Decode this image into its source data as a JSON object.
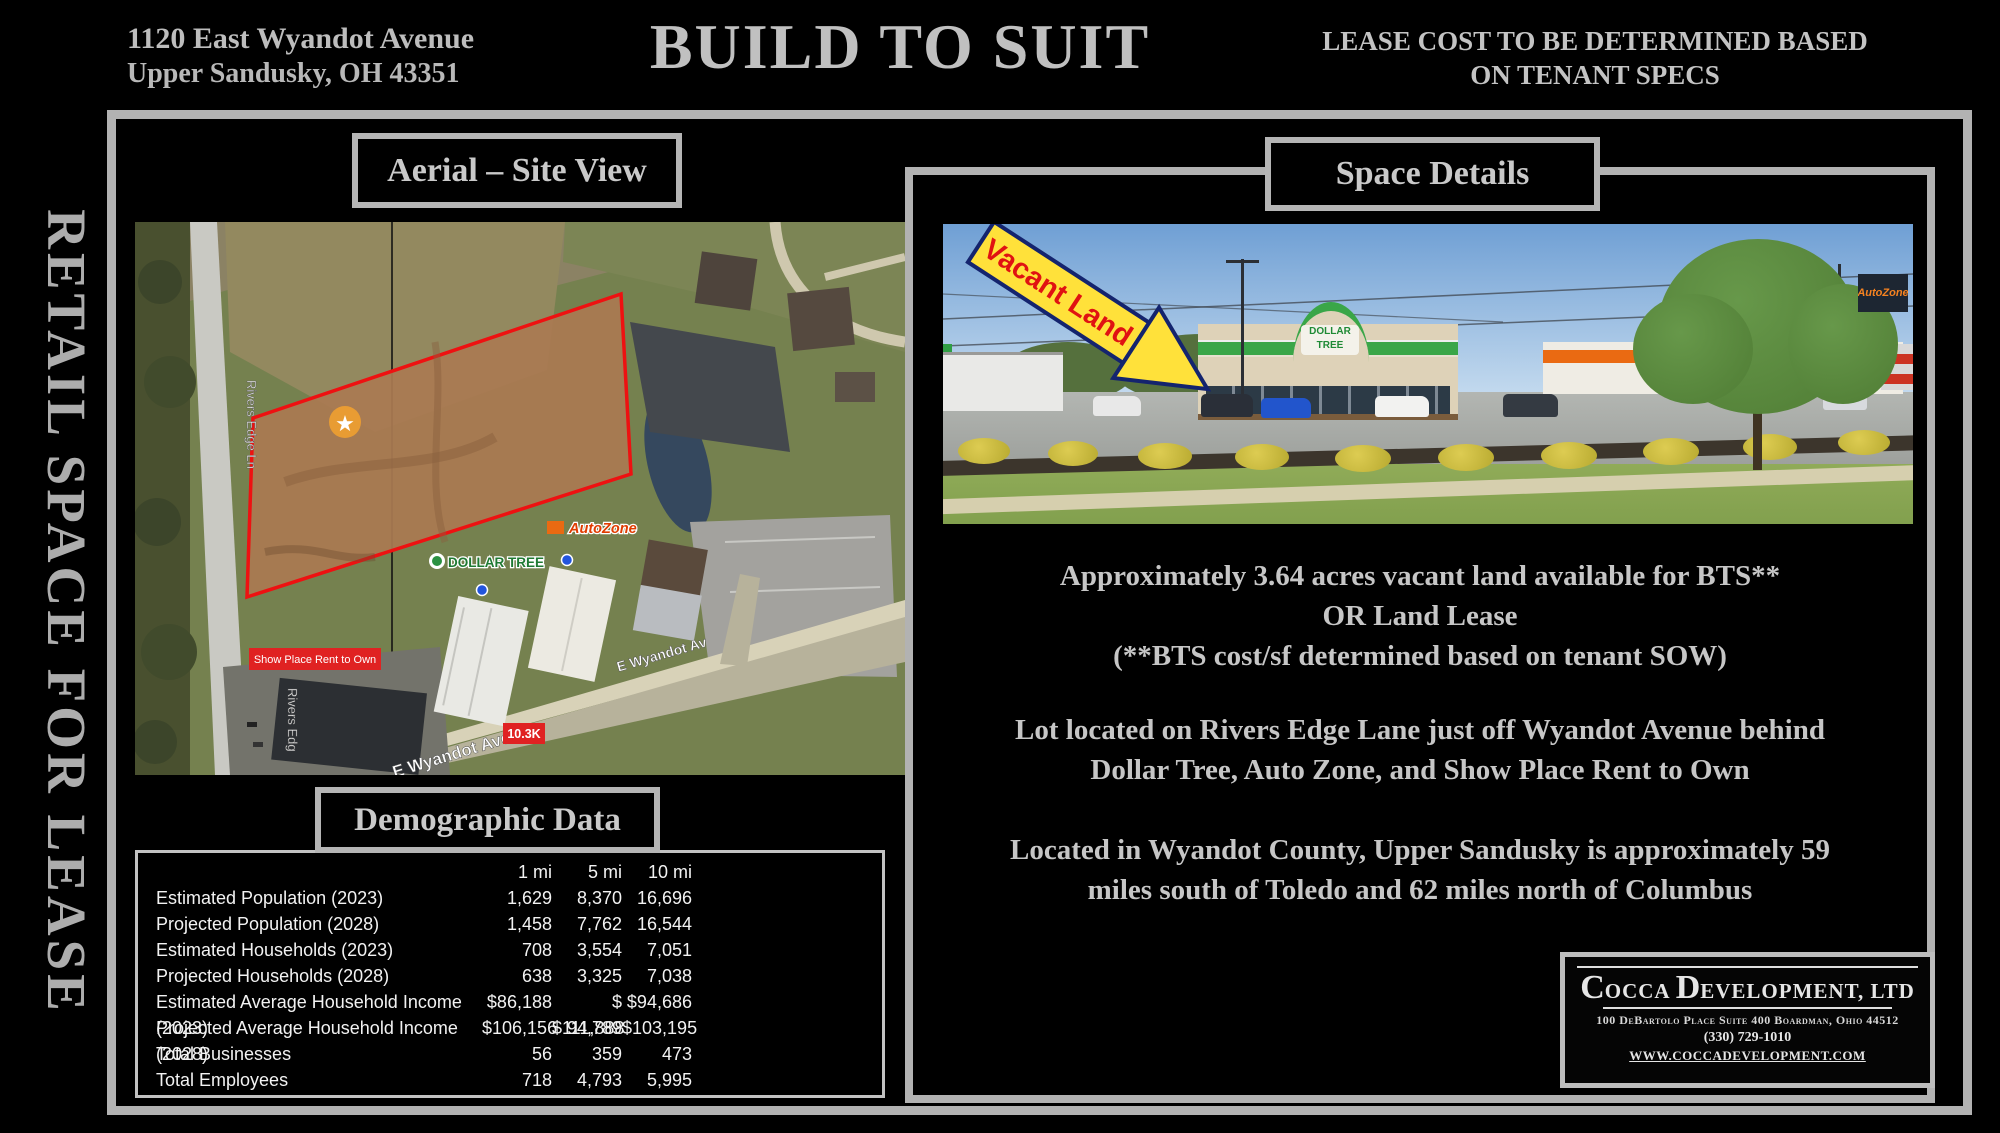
{
  "header": {
    "address_line1": "1120 East Wyandot Avenue",
    "address_line2": "Upper Sandusky, OH 43351",
    "title": "BUILD TO SUIT",
    "lease_note_line1": "LEASE COST TO BE DETERMINED BASED",
    "lease_note_line2": "ON TENANT SPECS"
  },
  "sidebar": {
    "vertical_text": "RETAIL SPACE FOR LEASE"
  },
  "aerial": {
    "title": "Aerial – Site View",
    "map_labels": {
      "road_vertical": "Rivers Edge Ln",
      "road_vertical_partial": "Rivers Edg",
      "road_diagonal": "E Wyandot Ave",
      "road_diagonal_short": "E Wyandot Av",
      "traffic_count": "10.3K",
      "store_dollar_tree": "DOLLAR TREE",
      "store_autozone": "AutoZone",
      "store_showplace": "Show Place Rent to Own",
      "marker_glyph": "★"
    }
  },
  "space_details": {
    "title": "Space Details",
    "photo_annotation": "Vacant Land",
    "photo_sign_dollar_tree": "DOLLAR TREE",
    "photo_sign_autozone": "AutoZone",
    "paragraph1": [
      "Approximately 3.64 acres vacant land available for BTS**",
      "OR Land Lease",
      "(**BTS cost/sf determined based on tenant SOW)"
    ],
    "paragraph2": [
      "Lot located on Rivers Edge Lane just off Wyandot Avenue behind",
      "Dollar Tree, Auto Zone, and Show Place Rent to Own"
    ],
    "paragraph3": [
      "Located in Wyandot County, Upper Sandusky is approximately 59",
      "miles south of Toledo and 62 miles north of Columbus"
    ]
  },
  "demographics": {
    "title": "Demographic Data",
    "columns": [
      "1 mi",
      "5 mi",
      "10 mi"
    ],
    "rows": [
      {
        "label": "Estimated Population (2023)",
        "values": [
          "1,629",
          "8,370",
          "16,696"
        ]
      },
      {
        "label": "Projected Population (2028)",
        "values": [
          "1,458",
          "7,762",
          "16,544"
        ]
      },
      {
        "label": "Estimated Households (2023)",
        "values": [
          "708",
          "3,554",
          "7,051"
        ]
      },
      {
        "label": "Projected Households (2028)",
        "values": [
          "638",
          "3,325",
          "7,038"
        ]
      },
      {
        "label": "Estimated Average Household Income (2023)",
        "values": [
          "$86,188",
          "$ 94,789",
          "$94,686"
        ]
      },
      {
        "label": "Projected Average Household Income (2028)",
        "values": [
          "$106,156",
          "$111,888",
          "$103,195"
        ]
      },
      {
        "label": "Total Businesses",
        "values": [
          "56",
          "359",
          "473"
        ]
      },
      {
        "label": "Total Employees",
        "values": [
          "718",
          "4,793",
          "5,995"
        ]
      }
    ]
  },
  "company": {
    "name_parts": [
      "C",
      "OCCA ",
      "D",
      "EVELOPMENT, LTD"
    ],
    "address": "100 DeBartolo Place Suite 400 Boardman, Ohio 44512",
    "phone": "(330) 729-1010",
    "website": "WWW.COCCADEVELOPMENT.COM"
  },
  "colors": {
    "background": "#000000",
    "frame_gray": "#b2b2b2",
    "text_gray": "#c6c6c6",
    "table_white": "#f2f2f2",
    "parcel_outline_red": "#ee1111",
    "label_red": "#e02222",
    "arrow_yellow": "#ffe13a",
    "arrow_outline_navy": "#14246e",
    "arrow_text_red": "#e01212",
    "dollar_tree_green": "#3aa648",
    "autozone_orange": "#ea6a12"
  }
}
